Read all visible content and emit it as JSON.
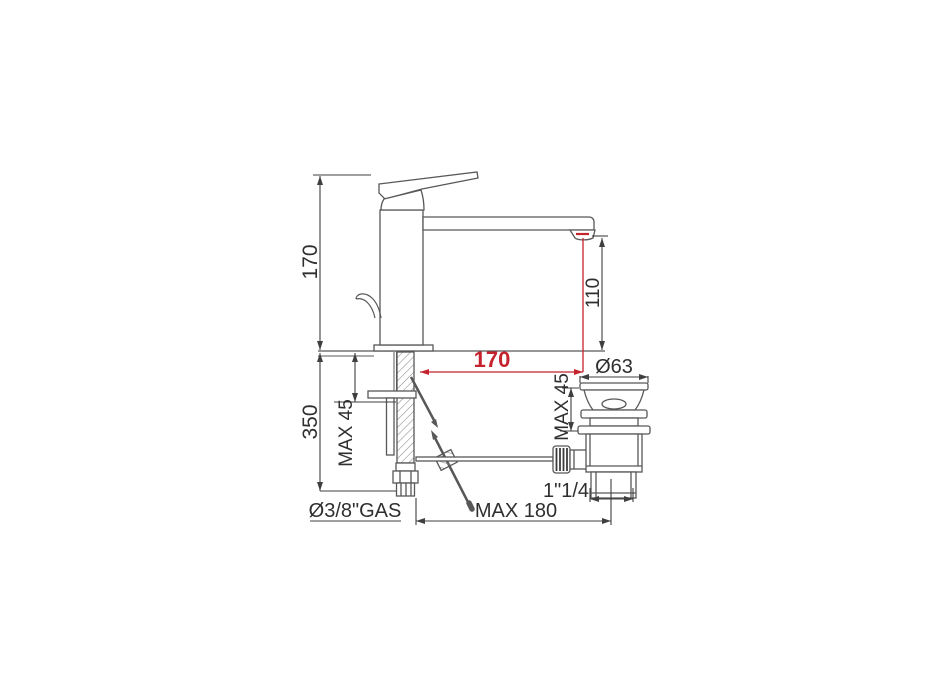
{
  "drawing": {
    "kind": "technical-dimension-drawing",
    "colors": {
      "outline": "#585858",
      "dimension": "#3f3f3f",
      "accent_red": "#c5232e",
      "background": "#ffffff"
    },
    "dimensions": {
      "total_height": "170",
      "spout_height": "110",
      "total_depth": "350",
      "deck_max_left": "MAX 45",
      "spout_reach": "170",
      "drain_diameter": "Ø63",
      "deck_max_right": "MAX 45",
      "drain_thread": "1\"1/4",
      "rod_max_reach": "MAX 180",
      "supply_thread": "Ø3/8\"GAS"
    }
  }
}
